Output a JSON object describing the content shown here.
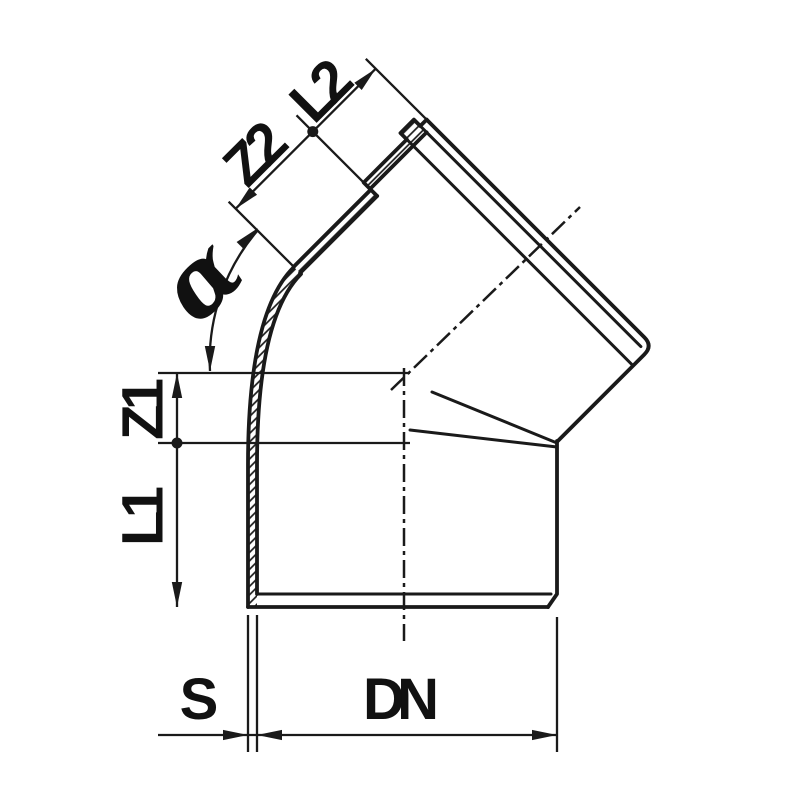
{
  "drawing": {
    "description": "Technical dimension drawing of a 45-degree pipe elbow with push-fit socket",
    "colors": {
      "line": "#1a1a1a",
      "background": "#ffffff"
    },
    "labels": {
      "angle": "α",
      "socket_z_offset": "Z2",
      "socket_length": "L2",
      "body_z_offset": "Z1",
      "body_length": "L1",
      "wall_thickness": "S",
      "nominal_diameter": "DN"
    }
  }
}
